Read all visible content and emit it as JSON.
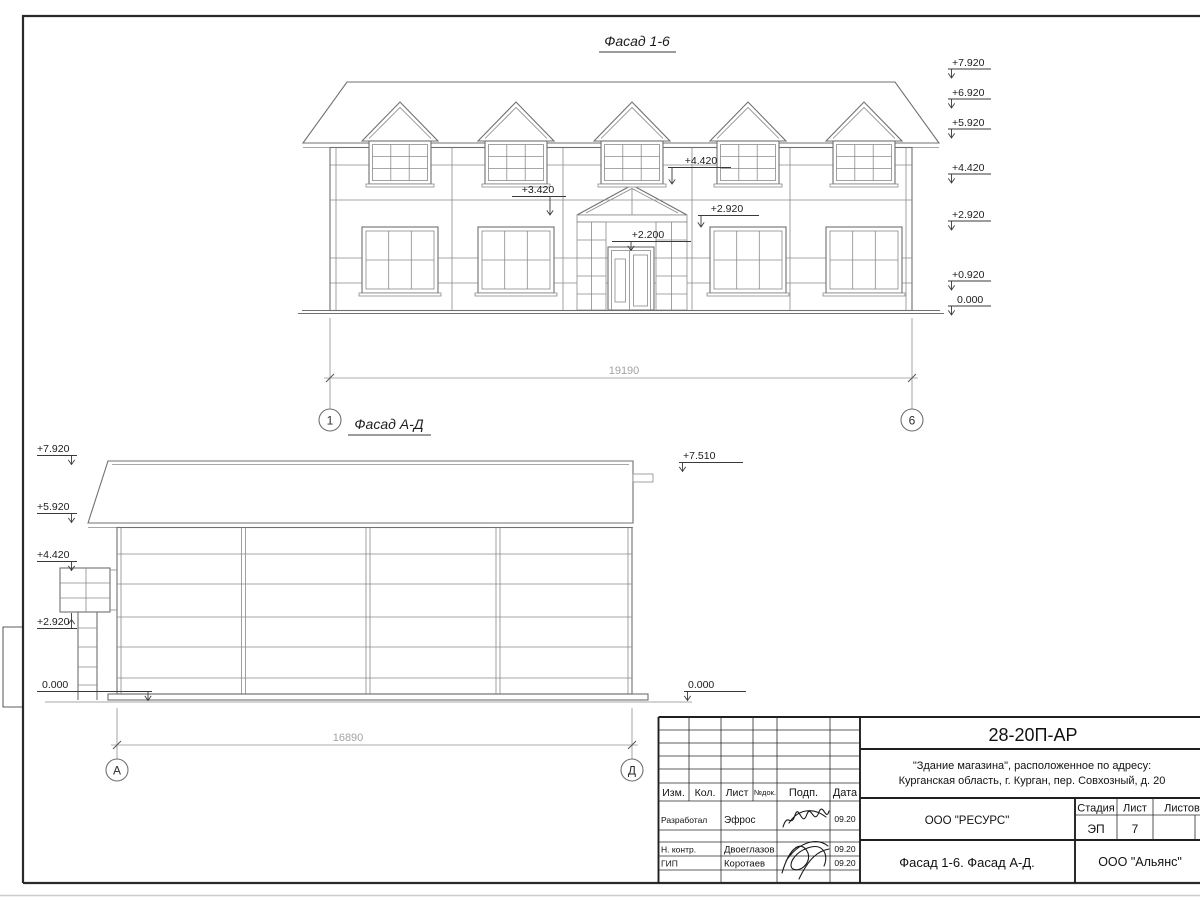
{
  "f16": {
    "title": "Фасад 1-6",
    "right_levels": [
      "+7.920",
      "+6.920",
      "+5.920",
      "+4.420",
      "+2.920",
      "+0.920",
      "0.000"
    ],
    "mark_dormer_sill": "+4.420",
    "mark_pediment": "+3.420",
    "mark_window_top": "+2.920",
    "mark_door_top": "+2.200",
    "dim": "19190",
    "axis_left": "1",
    "axis_right": "6"
  },
  "fad": {
    "title": "Фасад А-Д",
    "left_levels": [
      "+7.920",
      "+5.920",
      "+4.420",
      "+2.920",
      "0.000"
    ],
    "right_top": "+7.510",
    "right_zero": "0.000",
    "dim": "16890",
    "axis_left": "А",
    "axis_right": "Д"
  },
  "tb": {
    "code": "28-20П-АР",
    "object1": "\"Здание магазина\", расположенное по адресу:",
    "object2": "Курганская область, г. Курган, пер. Совхозный, д. 20",
    "col_izm": "Изм.",
    "col_kol": "Кол.",
    "col_list": "Лист",
    "col_ndok": "№док.",
    "col_podp": "Подп.",
    "col_data": "Дата",
    "r1_role": "Разработал",
    "r1_name": "Эфрос",
    "r1_date": "09.20",
    "r2_role": "Н. контр.",
    "r2_name": "Двоеглазов",
    "r2_date": "09.20",
    "r3_role": "ГИП",
    "r3_name": "Коротаев",
    "r3_date": "09.20",
    "org1": "ООО \"РЕСУРС\"",
    "stage_label": "Стадия",
    "list_label": "Лист",
    "listov_label": "Листов",
    "stage": "ЭП",
    "list_num": "7",
    "doc_title": "Фасад 1-6. Фасад А-Д.",
    "org2": "ООО \"Альянс\""
  }
}
